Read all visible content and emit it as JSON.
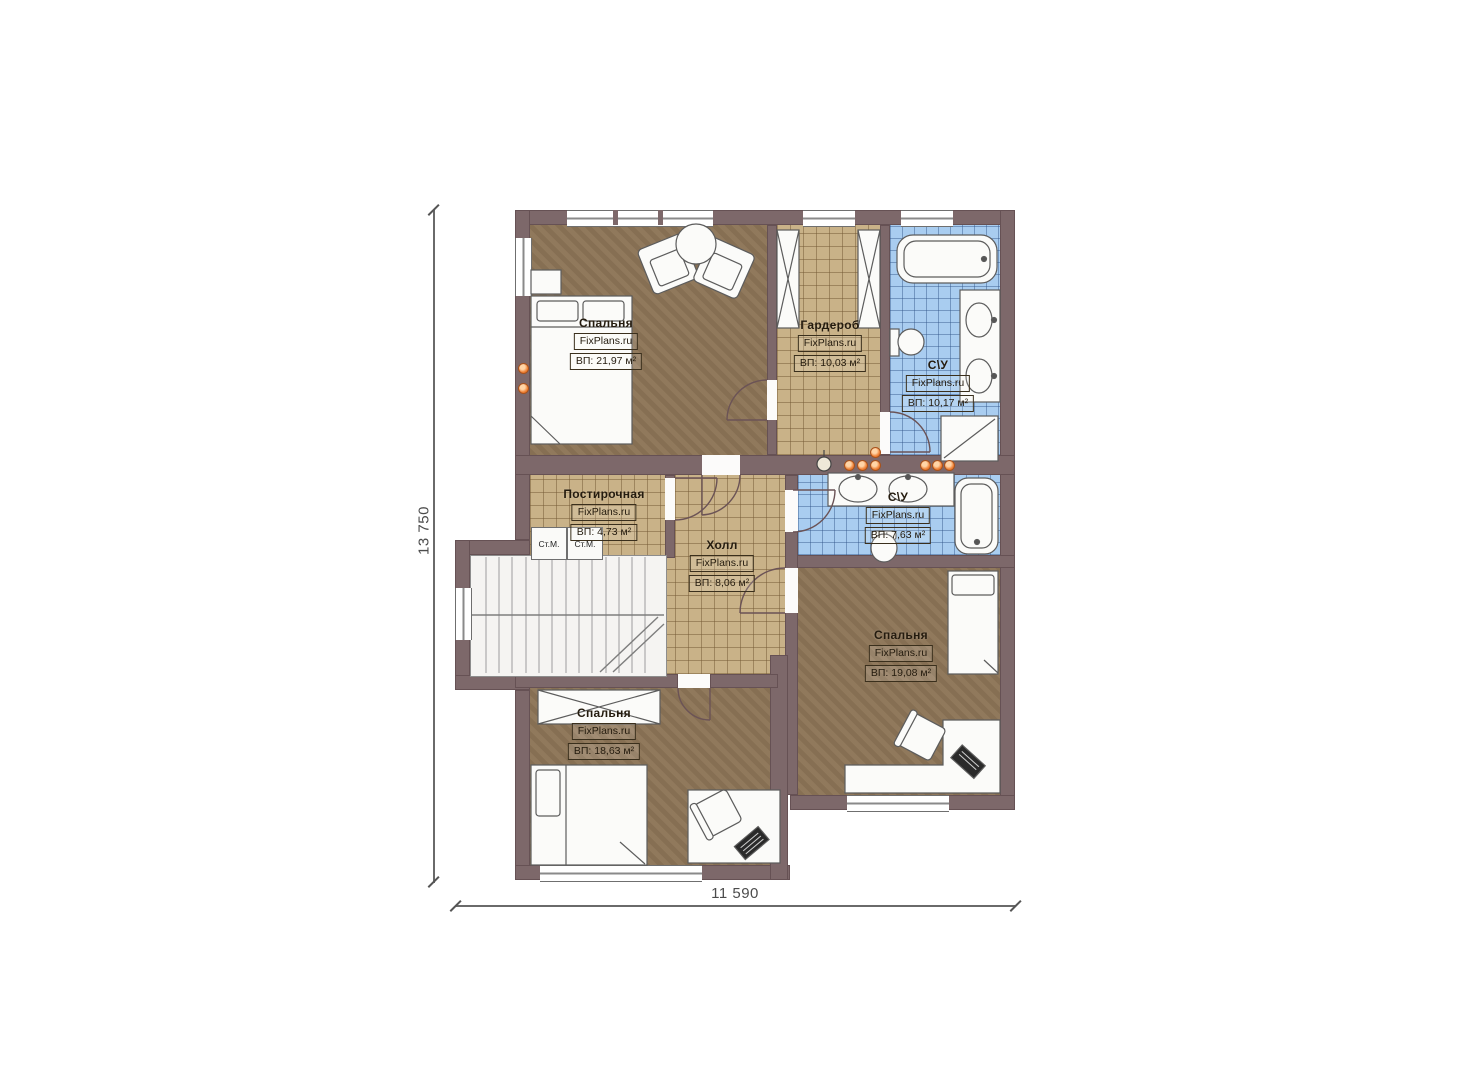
{
  "watermark": "FixPlans.ru",
  "rooms": [
    {
      "id": "bedroom-top-left",
      "name": "Спальня",
      "brand": "FixPlans.ru",
      "area": "ВП: 21,97 м²"
    },
    {
      "id": "wardrobe",
      "name": "Гардероб",
      "brand": "FixPlans.ru",
      "area": "ВП: 10,03 м²"
    },
    {
      "id": "bathroom-top",
      "name": "С\\У",
      "brand": "FixPlans.ru",
      "area": "ВП: 10,17 м²"
    },
    {
      "id": "laundry",
      "name": "Постирочная",
      "brand": "FixPlans.ru",
      "area": "ВП: 4,73 м²"
    },
    {
      "id": "hall",
      "name": "Холл",
      "brand": "FixPlans.ru",
      "area": "ВП: 8,06 м²"
    },
    {
      "id": "bathroom-middle",
      "name": "С\\У",
      "brand": "FixPlans.ru",
      "area": "ВП: 7,63 м²"
    },
    {
      "id": "bedroom-right",
      "name": "Спальня",
      "brand": "FixPlans.ru",
      "area": "ВП: 19,08 м²"
    },
    {
      "id": "bedroom-bottom",
      "name": "Спальня",
      "brand": "FixPlans.ru",
      "area": "ВП: 18,63 м²"
    }
  ],
  "appliances": {
    "washer_1": "Ст.М.",
    "washer_2": "Ст.М."
  },
  "dimensions": {
    "vertical": "13 750",
    "horizontal": "11 590"
  },
  "colors": {
    "wall": "#7d686a",
    "floor_brown": "#8d7557",
    "tile_beige": "#c9b288",
    "tile_blue": "#a9cdf0",
    "accent_orange": "#ed7d31"
  }
}
